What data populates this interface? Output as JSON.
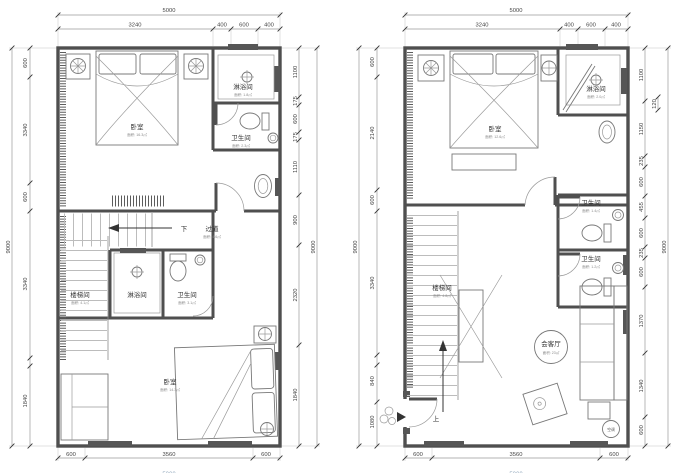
{
  "document": {
    "type": "architectural-floor-plan",
    "background": "#ffffff",
    "colors": {
      "wall": "#4f4f4f",
      "linework": "#787878",
      "dimension_text": "#444444"
    }
  },
  "plans": [
    {
      "id": "left-floor-plan",
      "dims": {
        "total_top": "5000",
        "top": [
          "3240",
          "400",
          "600",
          "400"
        ],
        "left_total": "9000",
        "left": [
          "600",
          "3340",
          "600",
          "3340",
          "1840"
        ],
        "right_total": "9000",
        "right": [
          "1100",
          "175",
          "600",
          "175",
          "1110",
          "900",
          "2320",
          "1840"
        ],
        "bottom": [
          "600",
          "3560",
          "600"
        ],
        "total_bottom": "5000"
      },
      "rooms": [
        {
          "label": "卧室",
          "area": "面积: 16.3㎡"
        },
        {
          "label": "淋浴间",
          "area": "面积: 1.8㎡"
        },
        {
          "label": "卫生间",
          "area": "面积: 2.3㎡"
        },
        {
          "label": "过道",
          "area": "面积: 4.6㎡"
        },
        {
          "label": "楼梯间",
          "area": "面积: 4.1㎡"
        },
        {
          "label": "淋浴间",
          "area": ""
        },
        {
          "label": "卫生间",
          "area": "面积: 3.1㎡"
        },
        {
          "label": "卧室",
          "area": "面积: 14.3㎡"
        }
      ],
      "annotations": {
        "down": "下"
      }
    },
    {
      "id": "right-floor-plan",
      "dims": {
        "total_top": "5000",
        "top": [
          "3240",
          "400",
          "600",
          "400"
        ],
        "left_total": "9000",
        "left": [
          "600",
          "2140",
          "600",
          "3340",
          "840",
          "1080"
        ],
        "right_total": "9000",
        "right_small": "120",
        "right": [
          "1100",
          "1150",
          "235",
          "600",
          "455",
          "600",
          "235",
          "600",
          "1370",
          "1340",
          "600"
        ],
        "bottom": [
          "600",
          "3560",
          "600"
        ],
        "total_bottom": "5000"
      },
      "rooms": [
        {
          "label": "卧室",
          "area": "面积: 12.6㎡"
        },
        {
          "label": "淋浴间",
          "area": "面积: 2.0㎡"
        },
        {
          "label": "卫生间",
          "area": "面积: 1.4㎡"
        },
        {
          "label": "卫生间",
          "area": "面积: 1.2㎡"
        },
        {
          "label": "楼梯间",
          "area": "面积: 4.8㎡"
        },
        {
          "label": "会客厅",
          "area": "面积: 23㎡"
        }
      ],
      "annotations": {
        "up": "上",
        "ac": "空调"
      }
    }
  ]
}
